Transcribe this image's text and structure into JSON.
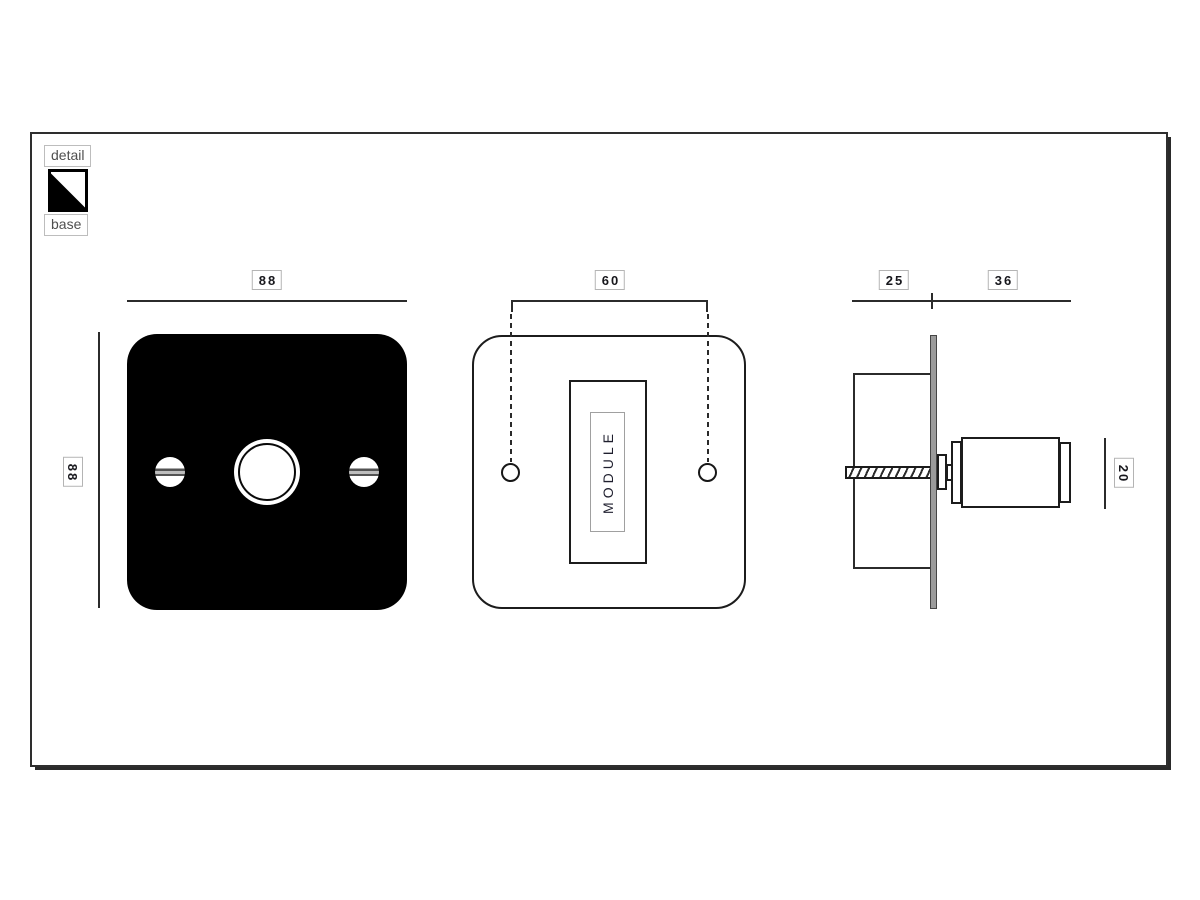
{
  "legend": {
    "detail": "detail",
    "base": "base"
  },
  "dimensions": {
    "front_width": "88",
    "front_height": "88",
    "module_hole_spacing": "60",
    "back_box_depth": "25",
    "knob_projection": "36",
    "knob_height": "20"
  },
  "module_label": "MODULE",
  "colors": {
    "outline": "#1c1c1c",
    "dimension_line": "#2b2b2b",
    "front_plate": "#000000",
    "wall_plate_section": "#9b9b9b",
    "label_border": "#b4b4b4",
    "dimension_text": "#17171c",
    "legend_text": "#4f4f4f"
  }
}
